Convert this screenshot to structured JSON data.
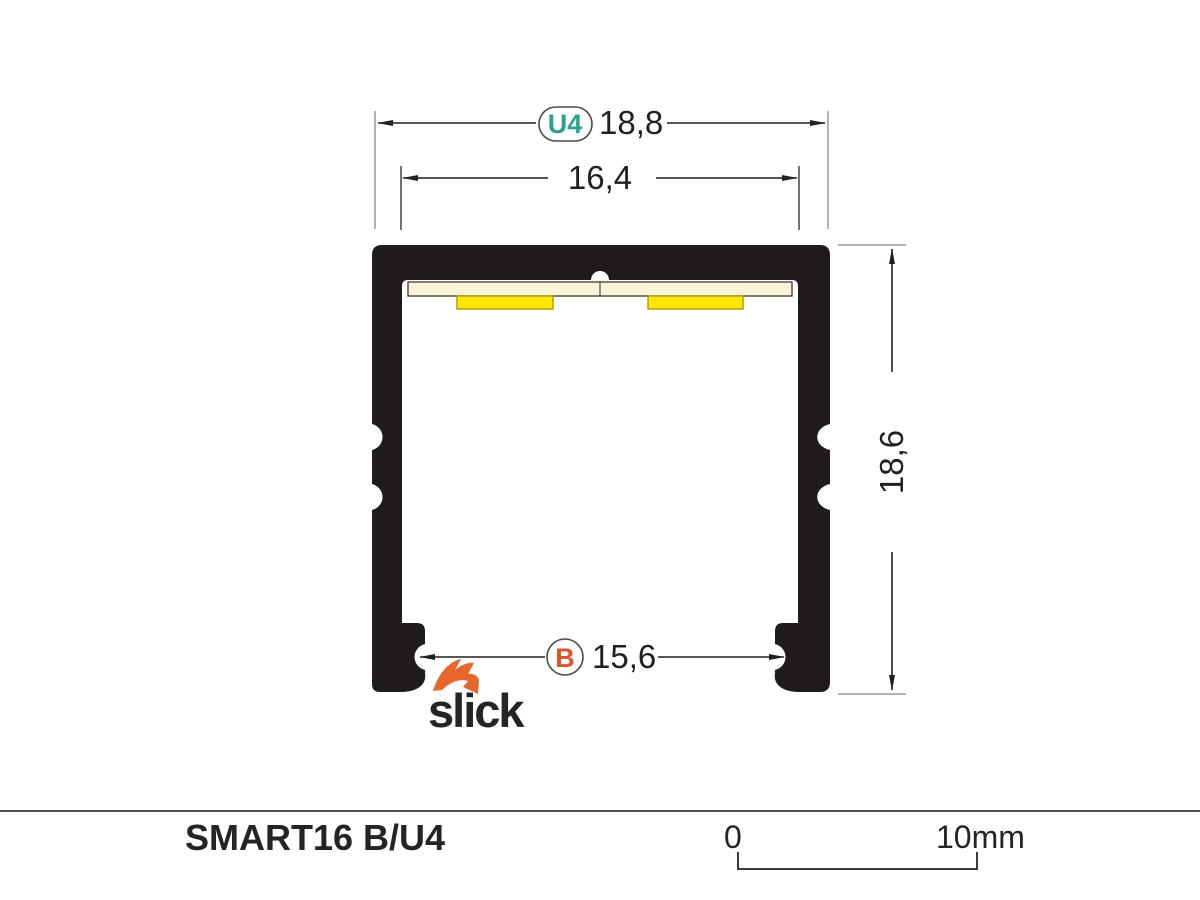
{
  "drawing": {
    "type": "led-profile-cross-section",
    "dimensions": {
      "overall_width": {
        "badge": "U4",
        "value": "18,8"
      },
      "inner_width": {
        "value": "16,4"
      },
      "height": {
        "value": "18,6"
      },
      "bottom_opening": {
        "badge": "B",
        "value": "15,6"
      }
    },
    "logo_text": "slick"
  },
  "footer": {
    "product_name": "SMART16 B/U4",
    "scale": {
      "start": "0",
      "end": "10mm"
    }
  },
  "colors": {
    "profile": "#201c1d",
    "badge_teal": "#2aa28e",
    "badge_orange": "#e0512a",
    "badge_ring": "#4a4a4a",
    "logo_orange": "#e7662b",
    "pcb": "#faf5da",
    "pcb_border": "#4a4738",
    "led": "#ffe604",
    "led_border": "#a89d00",
    "line_dark": "#231f20",
    "line_gray": "#a9a9a9"
  }
}
